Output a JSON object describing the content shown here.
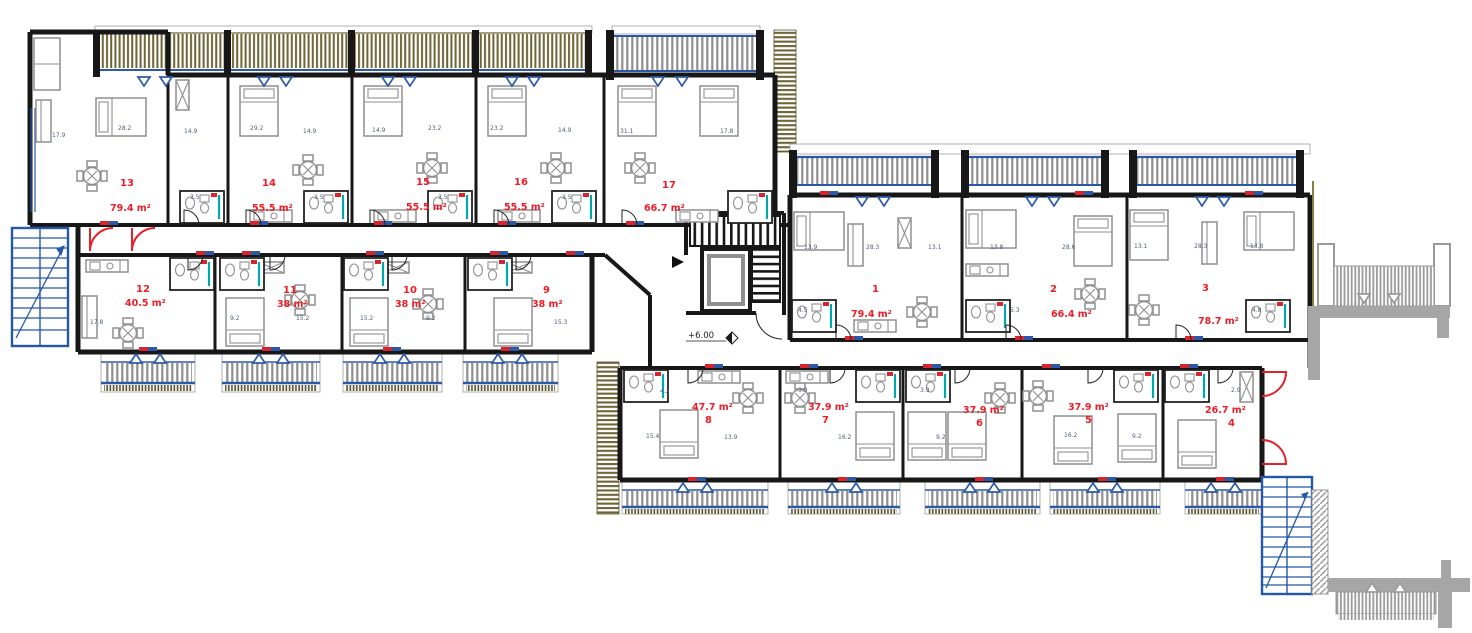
{
  "drawing": {
    "type": "architectural-floor-plan",
    "level_marker": "+6.00",
    "colors": {
      "wall": "#171717",
      "unit_label_red": "#ee1c25",
      "entrance_door_red": "#e62129",
      "stair_blue": "#2458a6",
      "glazing_blue": "#2b59a7",
      "balcony_olive": "#6e6434",
      "railing_gray": "#8f8f8f",
      "external_gray": "#a6a6a6",
      "shower_teal": "#00a8a8",
      "room_label": "#4f617a"
    },
    "units": [
      {
        "no": "13",
        "area": "79.4 m²",
        "rooms": [
          "17.9",
          "28.2",
          "14.9",
          "3.5"
        ]
      },
      {
        "no": "14",
        "area": "55.5 m²",
        "rooms": [
          "29.2",
          "14.9",
          "3.5"
        ]
      },
      {
        "no": "15",
        "area": "55.5 m²",
        "rooms": [
          "14.9",
          "23.2",
          "3.5"
        ]
      },
      {
        "no": "16",
        "area": "55.5 m²",
        "rooms": [
          "23.2",
          "14.9",
          "3.5"
        ]
      },
      {
        "no": "17",
        "area": "66.7 m²",
        "rooms": [
          "31.1",
          "17.8"
        ]
      },
      {
        "no": "12",
        "area": "40.5 m²",
        "rooms": [
          "17.8"
        ]
      },
      {
        "no": "11",
        "area": "38 m²",
        "rooms": [
          "9.2",
          "15.2"
        ]
      },
      {
        "no": "10",
        "area": "38 m²",
        "rooms": [
          "15.2",
          "9.2"
        ]
      },
      {
        "no": "9",
        "area": "38 m²",
        "rooms": [
          "15.3"
        ]
      },
      {
        "no": "1",
        "area": "79.4 m²",
        "rooms": [
          "13.9",
          "28.3",
          "13.1",
          "4.5"
        ]
      },
      {
        "no": "2",
        "area": "66.4 m²",
        "rooms": [
          "13.8",
          "28.6",
          "5.3"
        ]
      },
      {
        "no": "3",
        "area": "78.7 m²",
        "rooms": [
          "13.1",
          "28.3",
          "13.8",
          "4.8"
        ]
      },
      {
        "no": "8",
        "area": "47.7 m²",
        "rooms": [
          "15.4",
          "13.9",
          "4.2"
        ]
      },
      {
        "no": "7",
        "area": "37.9 m²",
        "rooms": [
          "16.2",
          "3.9"
        ]
      },
      {
        "no": "6",
        "area": "37.9 m²",
        "rooms": [
          "9.2",
          "3.9"
        ]
      },
      {
        "no": "5",
        "area": "37.9 m²",
        "rooms": [
          "16.2",
          "9.2"
        ]
      },
      {
        "no": "4",
        "area": "26.7 m²",
        "rooms": [
          "2.9"
        ]
      }
    ]
  }
}
